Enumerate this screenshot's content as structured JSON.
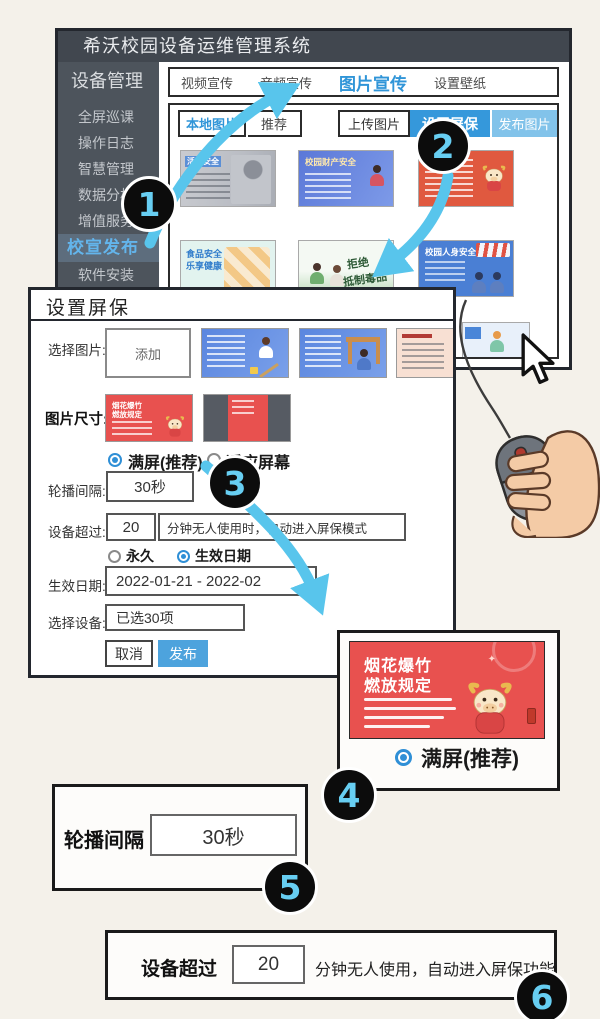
{
  "app": {
    "title": "希沃校园设备运维管理系统"
  },
  "sidebar": {
    "header": "设备管理",
    "items": [
      "全屏巡课",
      "操作日志",
      "智慧管理",
      "数据分析",
      "增值服务",
      "校宣发布",
      "软件安装"
    ],
    "active_item": "校宣发布"
  },
  "tabs": {
    "items": [
      "视频宣传",
      "音频宣传",
      "图片宣传",
      "设置壁纸"
    ],
    "active": "图片宣传"
  },
  "toolbar": {
    "local": "本地图片",
    "recommend": "推荐",
    "upload": "上传图片",
    "set_screensaver": "设置屏保",
    "publish_images": "发布图片"
  },
  "gallery": {
    "card1_title": "活动安全",
    "card2_title": "校园财产安全",
    "card4_title_line1": "食品安全",
    "card4_title_line2": "乐享健康",
    "card5_line1": "拒绝",
    "card5_line2": "抵制毒品",
    "card6_title": "校园人身安全"
  },
  "screensaver_card": {
    "title_line1": "烟花爆竹",
    "title_line2": "燃放规定"
  },
  "dialog": {
    "title": "设置屏保",
    "select_image_label": "选择图片:",
    "add_button": "添加",
    "size_label": "图片尺寸:",
    "fullscreen_option": "满屏(推荐)",
    "fit_option": "适应屏幕",
    "interval_label": "轮播间隔:",
    "interval_value": "30秒",
    "timeout_label": "设备超过:",
    "timeout_value": "20",
    "timeout_note": "分钟无人使用时，自动进入屏保模式",
    "forever_option": "永久",
    "effective_option": "生效日期",
    "date_label": "生效日期:",
    "date_value": "2022-01-21 - 2022-02",
    "devices_label": "选择设备:",
    "devices_value": "已选30项",
    "cancel_button": "取消",
    "publish_button": "发布"
  },
  "callout_fullscreen": {
    "radio_label": "满屏(推荐)"
  },
  "callout_interval": {
    "label": "轮播间隔",
    "value": "30秒"
  },
  "callout_timeout": {
    "label": "设备超过",
    "value": "20",
    "note": "分钟无人使用，自动进入屏保功能"
  },
  "steps": [
    "1",
    "2",
    "3",
    "4",
    "5",
    "6"
  ],
  "colors": {
    "accent_blue": "#3598db",
    "arrow_blue": "#58c5ec",
    "step_number_blue": "#67cef2",
    "card_red": "#e8514f",
    "titlebar_dark": "#41474f"
  }
}
